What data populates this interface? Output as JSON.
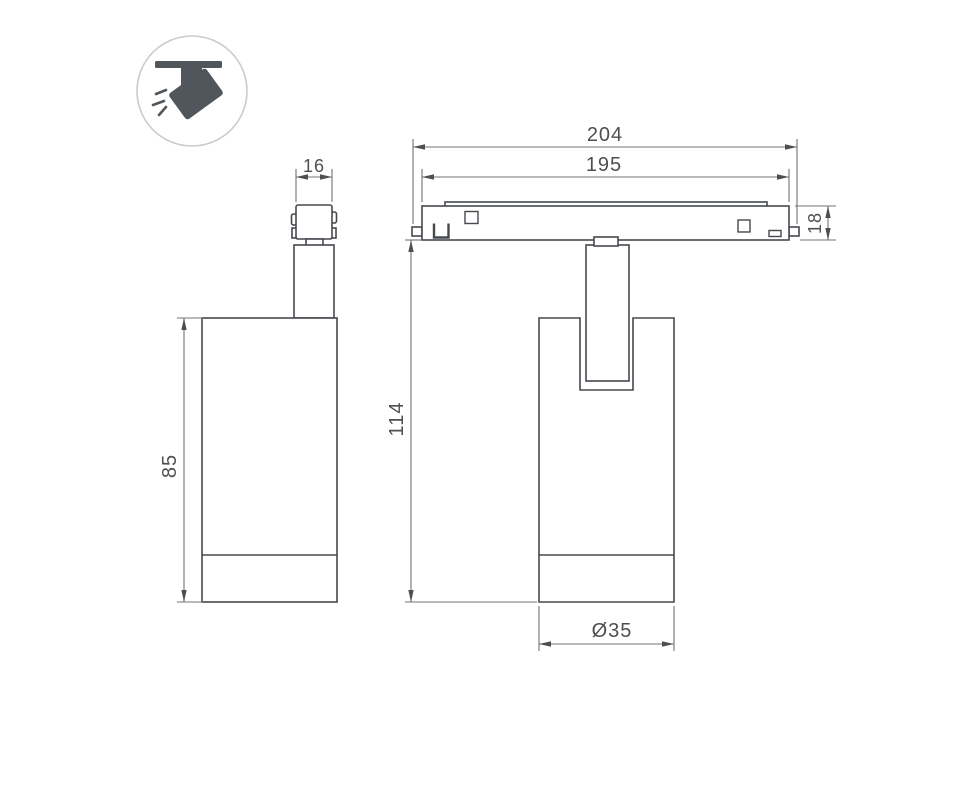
{
  "colors": {
    "background": "#ffffff",
    "object_line": "#45494e",
    "dimension_line": "#737373",
    "dimension_text": "#4f4f4f",
    "icon_fill": "#51565c",
    "icon_ring": "#c9cbcd"
  },
  "icon": {
    "label": "ceiling-track-spotlight"
  },
  "side_view": {
    "dim_adapter_width": "16",
    "dim_body_height": "85"
  },
  "front_view": {
    "dim_track_length": "204",
    "dim_track_inner_length": "195",
    "dim_track_height": "18",
    "dim_overall_height": "114",
    "dim_body_diameter": "Ø35"
  }
}
